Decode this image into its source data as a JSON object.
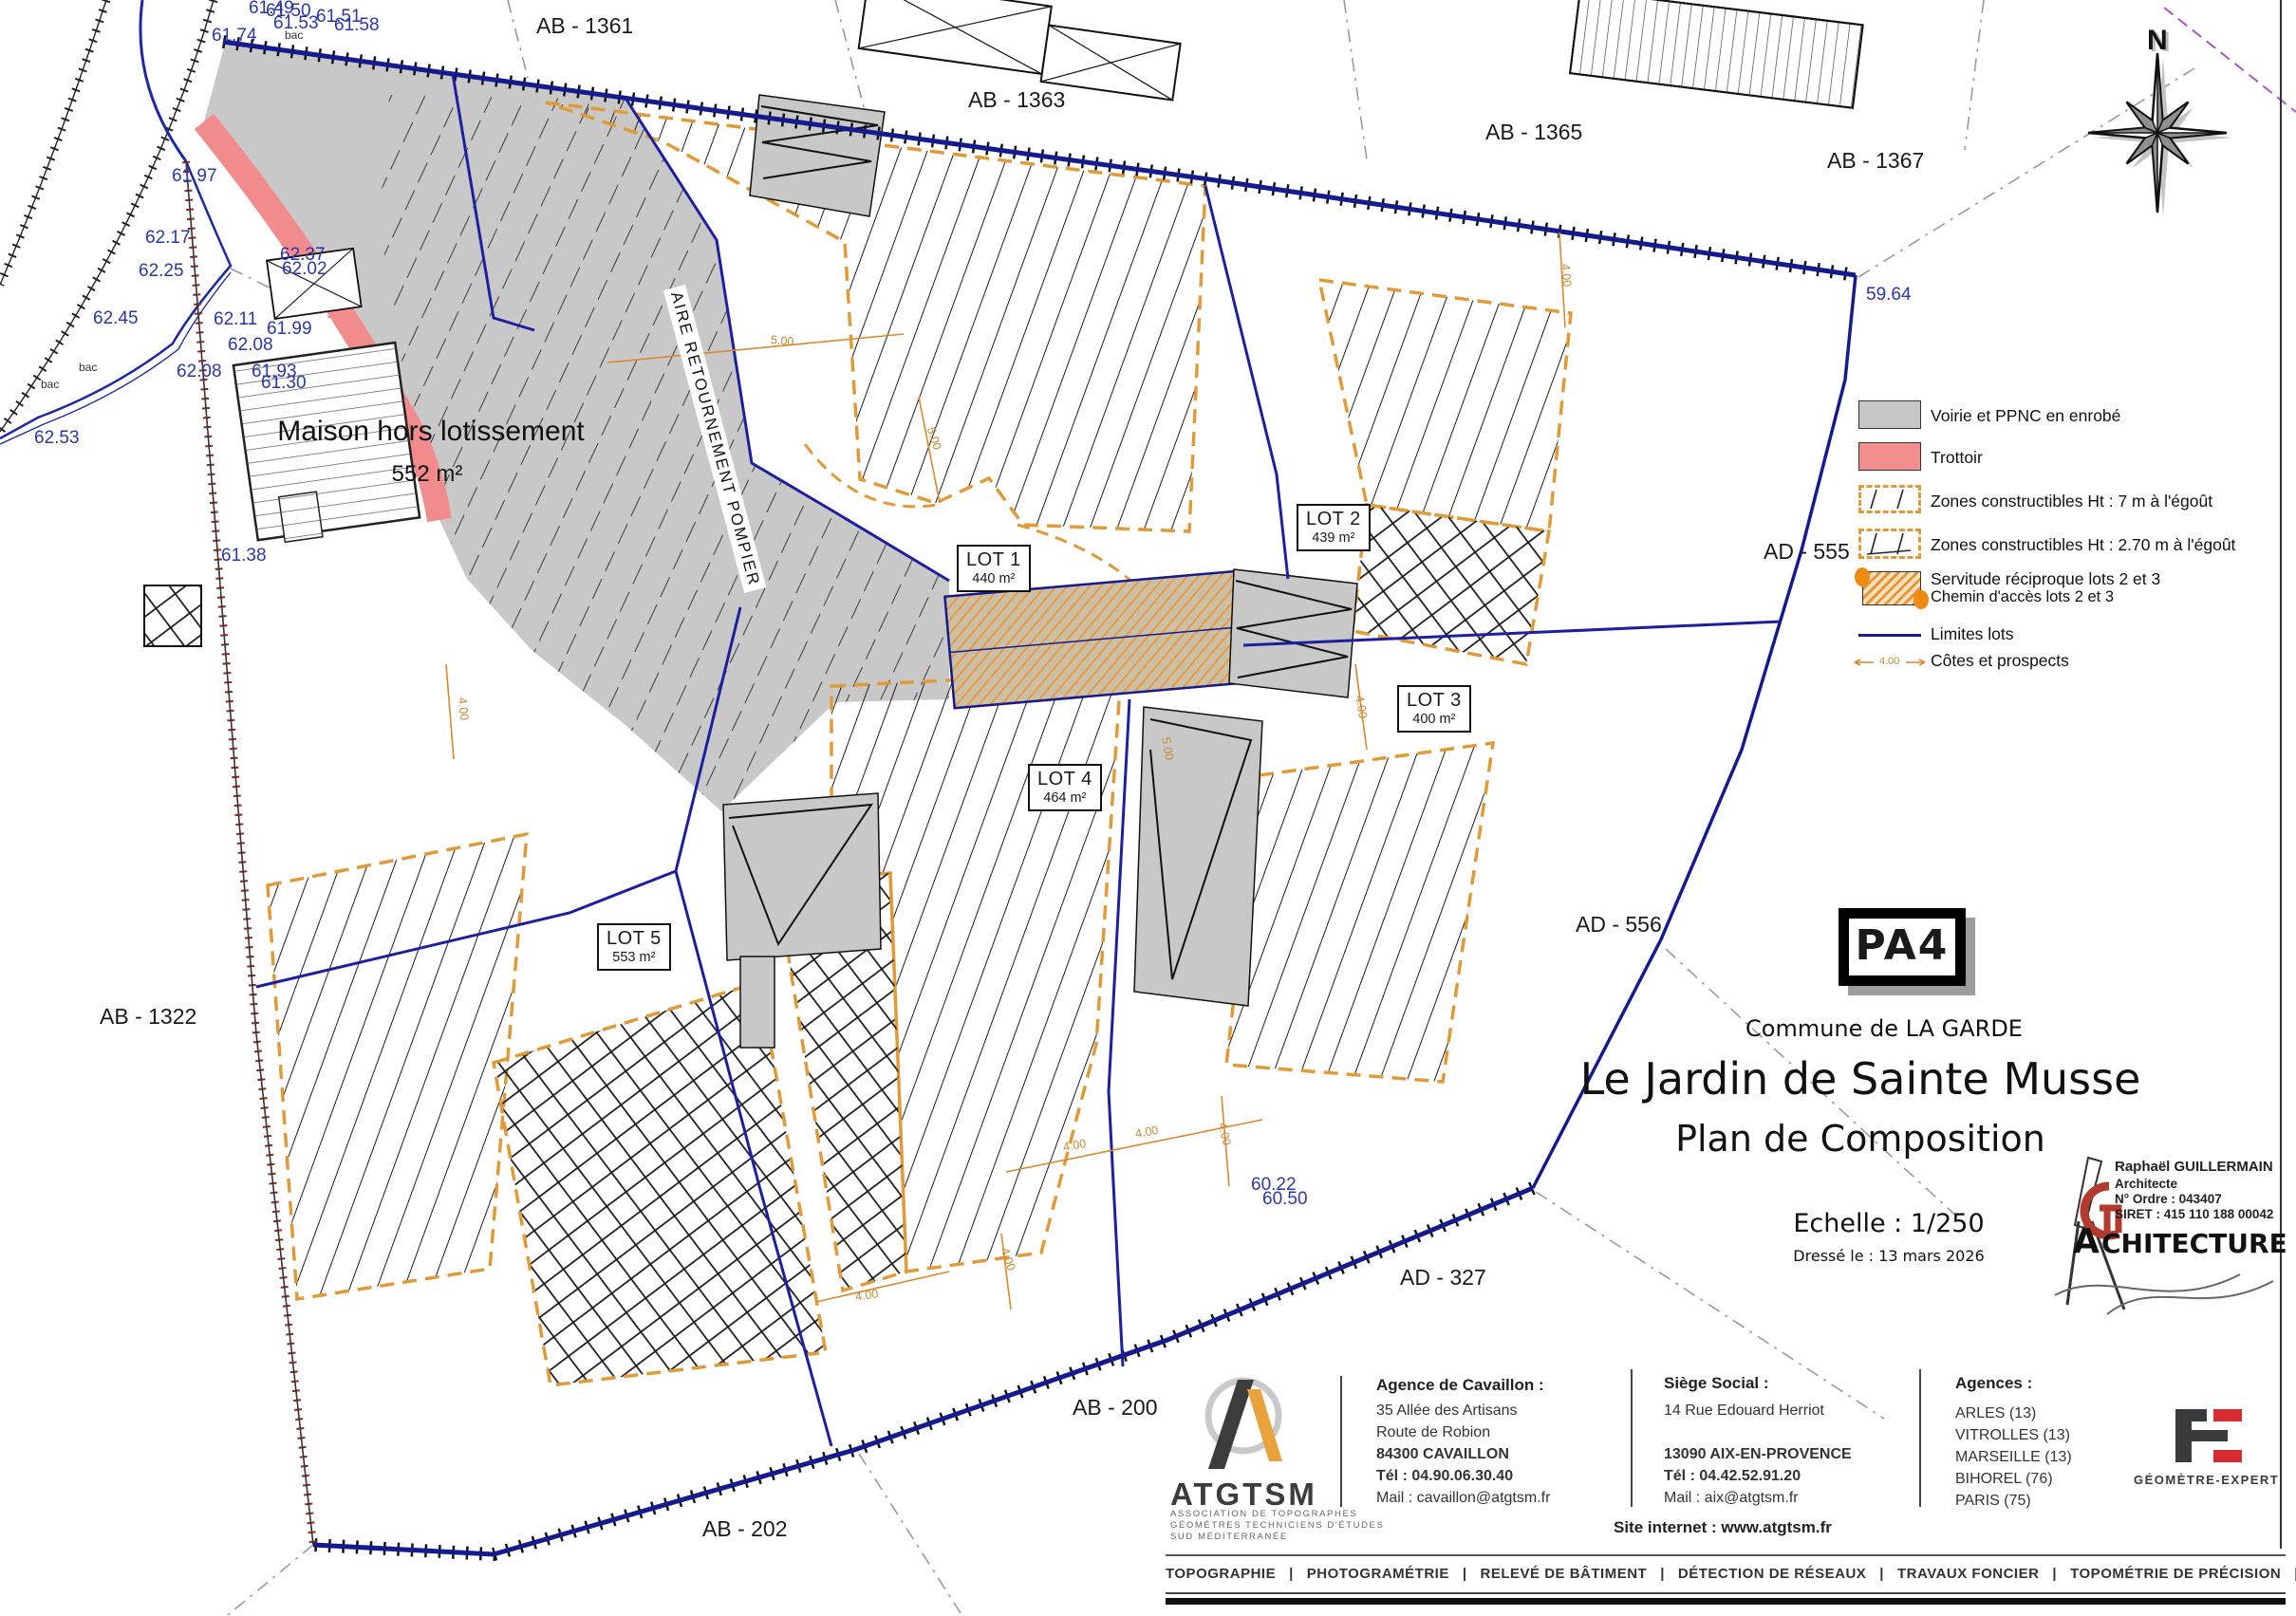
{
  "plan": {
    "parcel_labels": [
      {
        "t": "AB - 1361"
      },
      {
        "t": "AB - 1363"
      },
      {
        "t": "AB - 1365"
      },
      {
        "t": "AB - 1367"
      },
      {
        "t": "AB - 1322"
      },
      {
        "t": "AB - 200"
      },
      {
        "t": "AB - 202"
      },
      {
        "t": "AD - 555"
      },
      {
        "t": "AD - 556"
      },
      {
        "t": "AD - 327"
      }
    ],
    "lots": [
      {
        "name": "LOT 1",
        "area": "440 m²"
      },
      {
        "name": "LOT 2",
        "area": "439 m²"
      },
      {
        "name": "LOT 3",
        "area": "400 m²"
      },
      {
        "name": "LOT 4",
        "area": "464 m²"
      },
      {
        "name": "LOT 5",
        "area": "553 m²"
      }
    ],
    "maison_label": "Maison hors lotissement",
    "maison_area": "552 m²",
    "aire_label": "AIRE RETOURNEMENT POMPIER",
    "north": "N",
    "elevations": [
      "61.74",
      "61.53",
      "61.51",
      "61.58",
      "61.49",
      "61.50",
      "61.97",
      "62.17",
      "62.25",
      "62.45",
      "62.11",
      "61.99",
      "62.08",
      "62.08",
      "61.93",
      "61.30",
      "62.53",
      "61.38",
      "62.37",
      "62.02",
      "59.64",
      "60.22",
      "60.50"
    ],
    "bac": "bac",
    "dims": {
      "d400": "4.00",
      "d500": "5.00"
    }
  },
  "legend": {
    "items": [
      {
        "label": "Voirie et PPNC en enrobé"
      },
      {
        "label": "Trottoir"
      },
      {
        "label": "Zones constructibles Ht : 7 m à l'égoût"
      },
      {
        "label": "Zones constructibles Ht : 2.70 m à l'égoût"
      },
      {
        "label": "Servitude réciproque lots 2 et 3",
        "label2": "Chemin d'accès lots 2 et 3"
      },
      {
        "label": "Limites lots"
      },
      {
        "label": "Côtes et prospects"
      }
    ],
    "dim_label": "4.00",
    "colors": {
      "voirie": "#c6c6c6",
      "trottoir": "#f38e8e",
      "zones": "#e09a38",
      "servitude": "#e8953a",
      "limites": "#151a8c",
      "cotes": "#d9892f"
    }
  },
  "title_block": {
    "badge": "PA4",
    "commune": "Commune de LA GARDE",
    "title": "Le Jardin de Sainte Musse",
    "subtitle": "Plan de Composition",
    "scale": "Echelle : 1/250",
    "date": "Dressé le : 13 mars 2026",
    "architect": {
      "name": "Raphaël GUILLERMAIN",
      "role": "Architecte",
      "ordre": "N° Ordre : 043407",
      "siret": "SIRET : 415 110 188 00042",
      "brand_a": "A",
      "brand_rest": "CHITECTURE"
    }
  },
  "footer": {
    "logo": {
      "name": "ATGTSM",
      "sub1": "ASSOCIATION DE TOPOGRAPHES",
      "sub2": "GÉOMÈTRES TECHNICIENS D'ÉTUDES",
      "sub3": "SUD MÉDITERRANÉE"
    },
    "cavaillon": {
      "heading": "Agence de Cavaillon :",
      "l1": "35 Allée des Artisans",
      "l2": "Route de Robion",
      "l3": "84300 CAVAILLON",
      "l4": "Tél : 04.90.06.30.40",
      "l5": "Mail : cavaillon@atgtsm.fr"
    },
    "siege": {
      "heading": "Siège Social :",
      "l1": "14 Rue Edouard Herriot",
      "l2": "13090 AIX-EN-PROVENCE",
      "l3": "Tél : 04.42.52.91.20",
      "l4": "Mail : aix@atgtsm.fr"
    },
    "agences": {
      "heading": "Agences :",
      "l1": "ARLES (13)",
      "l2": "VITROLLES (13)",
      "l3": "MARSEILLE (13)",
      "l4": "BIHOREL (76)",
      "l5": "PARIS (75)"
    },
    "site": "Site internet : www.atgtsm.fr",
    "geometre": "GÉOMÈTRE-EXPERT",
    "services_line": "TOPOGRAPHIE   |   PHOTOGRAMÉTRIE   |   RELEVÉ DE BÂTIMENT   |   DÉTECTION DE RÉSEAUX   |   TRAVAUX FONCIER   |   TOPOMÉTRIE DE PRÉCISION   |   BIM"
  }
}
